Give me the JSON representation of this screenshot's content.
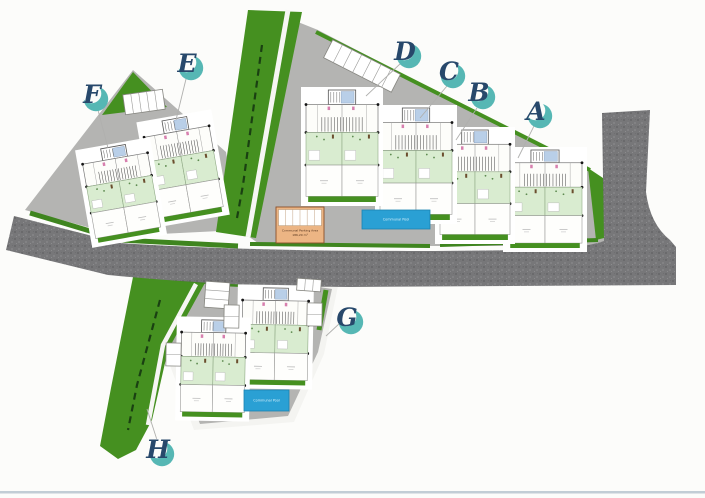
{
  "scene": {
    "width": 705,
    "height": 498,
    "background": "#fcfcfa",
    "bottom_rule_color": "#c2cdd5"
  },
  "palette": {
    "green": "#459020",
    "hedge": "#3f851f",
    "plot_gray": "#b4b4b2",
    "road_gray": "#767678",
    "pool_blue": "#2aa0d4",
    "parking_tan": "#ecb584",
    "marker_teal": "#56b7b4",
    "marker_navy": "#27486b",
    "leader_gray": "#b0b0ae"
  },
  "markers": [
    {
      "label": "A",
      "cx": 540,
      "cy": 116,
      "leader": [
        [
          534,
          126
        ],
        [
          518,
          158
        ]
      ]
    },
    {
      "label": "B",
      "cx": 483,
      "cy": 97,
      "leader": [
        [
          477,
          108
        ],
        [
          456,
          140
        ]
      ]
    },
    {
      "label": "C",
      "cx": 453,
      "cy": 76,
      "leader": [
        [
          447,
          86
        ],
        [
          420,
          118
        ]
      ]
    },
    {
      "label": "D",
      "cx": 409,
      "cy": 56,
      "leader": [
        [
          400,
          64
        ],
        [
          366,
          96
        ]
      ]
    },
    {
      "label": "E",
      "cx": 191,
      "cy": 68,
      "leader": [
        [
          186,
          79
        ],
        [
          176,
          120
        ]
      ]
    },
    {
      "label": "F",
      "cx": 96,
      "cy": 99,
      "leader": [
        [
          98,
          110
        ],
        [
          108,
          148
        ]
      ]
    },
    {
      "label": "G",
      "cx": 351,
      "cy": 322,
      "leader": [
        [
          340,
          323
        ],
        [
          326,
          336
        ]
      ]
    },
    {
      "label": "H",
      "cx": 162,
      "cy": 454,
      "leader": [
        [
          158,
          443
        ],
        [
          147,
          409
        ]
      ]
    }
  ],
  "buildings": [
    {
      "name": "building-a",
      "x": 508,
      "y": 150,
      "w": 74,
      "h": 98,
      "rot": 0
    },
    {
      "name": "building-b",
      "x": 440,
      "y": 130,
      "w": 70,
      "h": 110,
      "rot": 0
    },
    {
      "name": "building-c",
      "x": 380,
      "y": 108,
      "w": 72,
      "h": 112,
      "rot": 0
    },
    {
      "name": "building-d",
      "x": 306,
      "y": 90,
      "w": 72,
      "h": 112,
      "rot": 0
    },
    {
      "name": "building-e",
      "x": 150,
      "y": 118,
      "w": 66,
      "h": 100,
      "rot": -10
    },
    {
      "name": "building-f",
      "x": 88,
      "y": 146,
      "w": 66,
      "h": 92,
      "rot": -10
    },
    {
      "name": "building-g1",
      "x": 242,
      "y": 288,
      "w": 66,
      "h": 97,
      "rot": 1
    },
    {
      "name": "building-g2",
      "x": 181,
      "y": 320,
      "w": 64,
      "h": 97,
      "rot": 1
    }
  ],
  "pools": [
    {
      "x": 362,
      "y": 210,
      "w": 68,
      "h": 19,
      "label": "Communal Pool"
    },
    {
      "x": 244,
      "y": 390,
      "w": 45,
      "h": 21,
      "label": "Communal Pool"
    }
  ],
  "parking": {
    "x": 276,
    "y": 207,
    "w": 48,
    "h": 36,
    "line1": "Communal Parking Area",
    "line2": "186,20 m²"
  },
  "stall_strips": [
    {
      "x": 124,
      "y": 92,
      "w": 40,
      "h": 20,
      "rot": -8,
      "count": 5
    },
    {
      "x": 324,
      "y": 56,
      "w": 76,
      "h": 20,
      "rot": 27,
      "count": 7
    },
    {
      "x": 297,
      "y": 279,
      "w": 24,
      "h": 12,
      "rot": 4,
      "count": 3
    },
    {
      "x": 205,
      "y": 282,
      "w": 24,
      "h": 26,
      "rot": 4,
      "count": 3
    },
    {
      "x": 224,
      "y": 305,
      "w": 15,
      "h": 23,
      "rot": 1,
      "count": 2
    },
    {
      "x": 307,
      "y": 303,
      "w": 15,
      "h": 23,
      "rot": 1,
      "count": 2
    },
    {
      "x": 166,
      "y": 343,
      "w": 15,
      "h": 23,
      "rot": 1,
      "count": 2
    }
  ]
}
